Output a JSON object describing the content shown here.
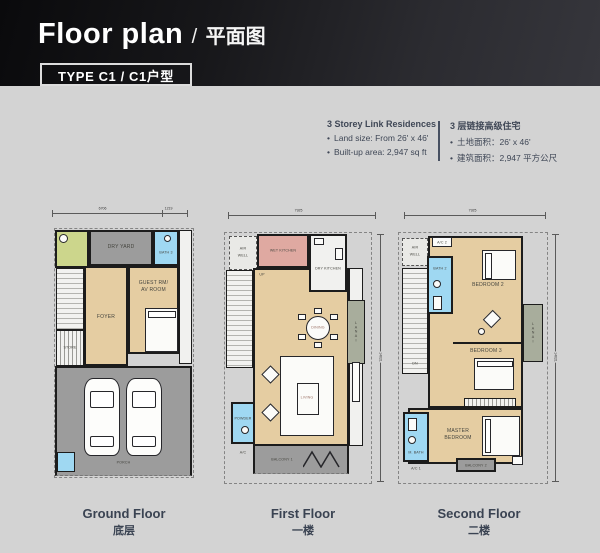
{
  "header": {
    "title_en": "Floor plan",
    "title_sep": "/",
    "title_zh": "平面图",
    "type_badge": "TYPE C1 / C1户型"
  },
  "info": {
    "bullet_glyph": "•",
    "en": {
      "heading": "3 Storey Link Residences",
      "bullet1": "Land size: From 26' x 46'",
      "bullet2": "Built-up area: 2,947 sq ft"
    },
    "zh": {
      "heading": "3 层链接高级住宅",
      "bullet1": "土地面积：26' x 46'",
      "bullet2": "建筑面积：2,947 平方公尺"
    }
  },
  "plans": {
    "ground": {
      "caption_en": "Ground Floor",
      "caption_zh": "底层",
      "dim_top_left": "6706",
      "dim_top_right": "1219",
      "rooms": {
        "dry_yard": "DRY YARD",
        "bath3": "BATH 3",
        "up": "UP",
        "foyer": "FOYER",
        "guest_line1": "GUEST RM/",
        "guest_line2": "AV ROOM",
        "store": "STORE",
        "porch": "PORCH"
      }
    },
    "first": {
      "caption_en": "First Floor",
      "caption_zh": "一楼",
      "dim_top": "7925",
      "dim_right": "14021",
      "rooms": {
        "air_well_1": "AIR",
        "air_well_2": "WELL",
        "wet_kitchen": "WET KITCHEN",
        "dry_kitchen": "DRY KITCHEN",
        "up": "UP",
        "dining": "DINING",
        "lanai": "LANAI",
        "living": "LIVING",
        "powder": "POWDER",
        "ac": "A/C",
        "balcony1": "BALCONY 1"
      }
    },
    "second": {
      "caption_en": "Second Floor",
      "caption_zh": "二楼",
      "dim_top": "7925",
      "dim_right": "14021",
      "rooms": {
        "air_well_1": "AIR",
        "air_well_2": "WELL",
        "ac2": "A/C 2",
        "bath2": "BATH 2",
        "bedroom2": "BEDROOM 2",
        "dn": "DN",
        "lanai": "LANAI",
        "bedroom3": "BEDROOM 3",
        "master_line1": "MASTER",
        "master_line2": "BEDROOM",
        "m_bath": "M. BATH",
        "ac1": "A/C 1",
        "balcony2": "BALCONY 2"
      }
    }
  }
}
